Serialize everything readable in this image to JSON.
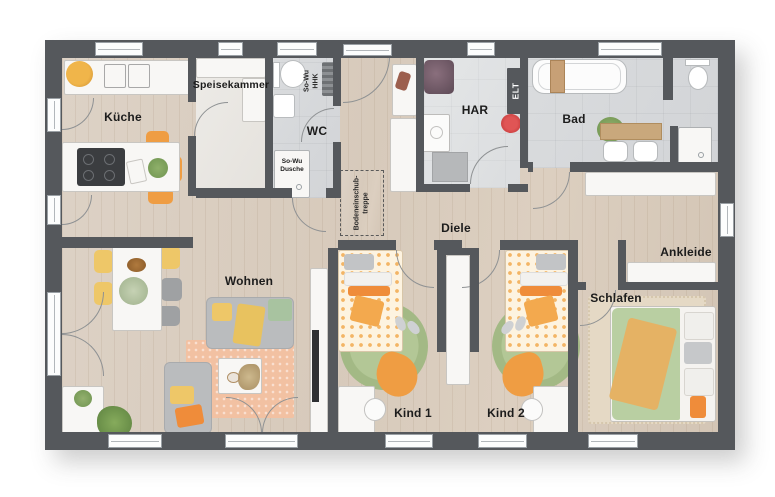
{
  "rooms": {
    "kueche": "Küche",
    "speisekammer": "Speisekammer",
    "wc": "WC",
    "har": "HAR",
    "bad": "Bad",
    "diele": "Diele",
    "wohnen": "Wohnen",
    "kind1": "Kind 1",
    "kind2": "Kind 2",
    "schlafen": "Schlafen",
    "ankleide": "Ankleide"
  },
  "annotations": {
    "so_wu_hhk": {
      "line1": "So-Wu",
      "line2": "HHK"
    },
    "so_wu_dusche": {
      "line1": "So-Wu",
      "line2": "Dusche"
    },
    "elt": "ELT",
    "bodeneinschubtreppe": {
      "line1": "Bodeneinschub-",
      "line2": "treppe"
    }
  },
  "colors": {
    "wall": "#55585c",
    "wood_floor": "#d9cdc0",
    "tile_floor": "#d6d8da",
    "accent_orange": "#ef9d43",
    "accent_yellow": "#eec768",
    "rug_green": "#a9be8d",
    "rug_orange": "#f2c1a2",
    "bed_green": "#b8cfa2",
    "vacuum_red": "#cc3333"
  }
}
